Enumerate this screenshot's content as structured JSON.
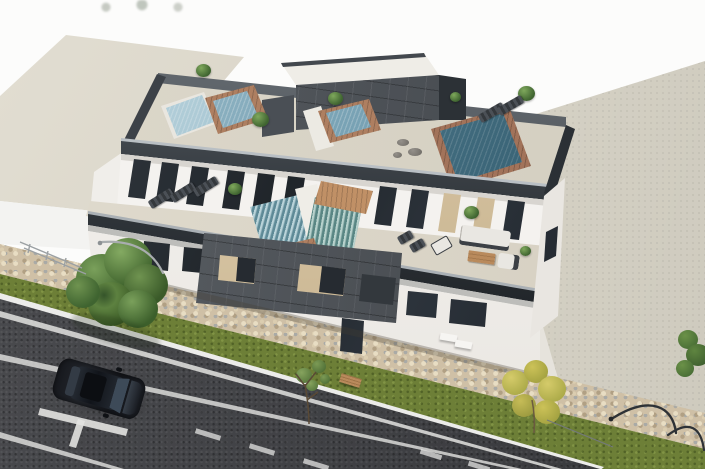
{
  "meta": {
    "type": "3d-architectural-render",
    "description": "Aerial 3D rendering of a modern three-storey apartment building with rooftop plunge pools, glass balustrades and furnished terraces; cobblestone sidewalk, grass verge with trees, curved street lamps, an asphalt road with white markings and a parked dark SUV; beige neighbouring building at left and an empty beige lot at right."
  },
  "palette": {
    "bg": "#fcfcfb",
    "neighbor-roof": "#d8d3c6",
    "neighbor-face": "#f3f3f1",
    "lot": "#d9d5c8",
    "apron": "#e6e3dc",
    "sidewalk": "#cfc0a6",
    "grass": "#6d7f37",
    "asphalt": "#3f4044",
    "marking": "#e3e3e1",
    "curb": "#ececea",
    "deck": "#d8d3c6",
    "terrace": "#dcd7ca",
    "wall": "#f4f2ef",
    "parapet": "#24282d",
    "fascia": "#bdbdba",
    "cladding": "#4b5056",
    "opening": "#d8c5a3",
    "glass": "#262b31",
    "brick": "#ae7f61",
    "wood": "#c09066",
    "pool-light": "#a3c8d6",
    "pool-mid": "#6fa0b5",
    "pool-dark": "#3f6b80",
    "plant-light": "#7fa85c",
    "plant-dark": "#3f6430",
    "tree-yellow": "#c6bc57",
    "furniture": "#3c4045",
    "cushion": "#e9e7e2",
    "car-body": "#14161b",
    "car-glass": "#3d4a58",
    "lamp": "#a9adaf",
    "lamp-dark": "#2e3236",
    "bench-wood": "#b98a5c"
  },
  "scene": {
    "background": {
      "label": "white sky backdrop"
    },
    "neighbor_building": {
      "label": "neighbouring low building",
      "roof_color": "#d8d3c6"
    },
    "vacant_lot": {
      "label": "empty paved lot",
      "color": "#d9d5c8"
    },
    "main_building": {
      "label": "modern apartment block",
      "storeys": 3,
      "rooftop": {
        "pools": 4,
        "pool_colors": [
          "#a3c8d6",
          "#6fa0b5",
          "#6fa0b5",
          "#3f6b80"
        ],
        "features": [
          "brick pool surrounds",
          "stair access box",
          "potted plants",
          "sun loungers",
          "dark glass balustrade"
        ]
      },
      "terrace": {
        "pools": 2,
        "features": [
          "textured water",
          "timber deck",
          "sun loungers",
          "corner sofa with white cushions",
          "wooden coffee table",
          "armchair",
          "potted plants"
        ]
      },
      "facade": {
        "features": [
          "anthracite tile cladding",
          "recessed balconies with beige reveals",
          "dark glazed windows",
          "entrance door",
          "white benches"
        ]
      }
    },
    "street": {
      "label": "asphalt road",
      "markings": [
        "kerb line",
        "edge line",
        "centre lane line",
        "parking tee",
        "dashed bay lines"
      ]
    },
    "sidewalk": {
      "label": "cobblestone pavement"
    },
    "verge": {
      "label": "grass strip",
      "items": [
        "large green tree",
        "young sapling",
        "yellow-green tree",
        "shrub",
        "timber bench"
      ]
    },
    "street_lamps": {
      "count": 3,
      "style": "curved arm"
    },
    "car": {
      "label": "parked dark SUV",
      "color": "#14161b"
    }
  }
}
